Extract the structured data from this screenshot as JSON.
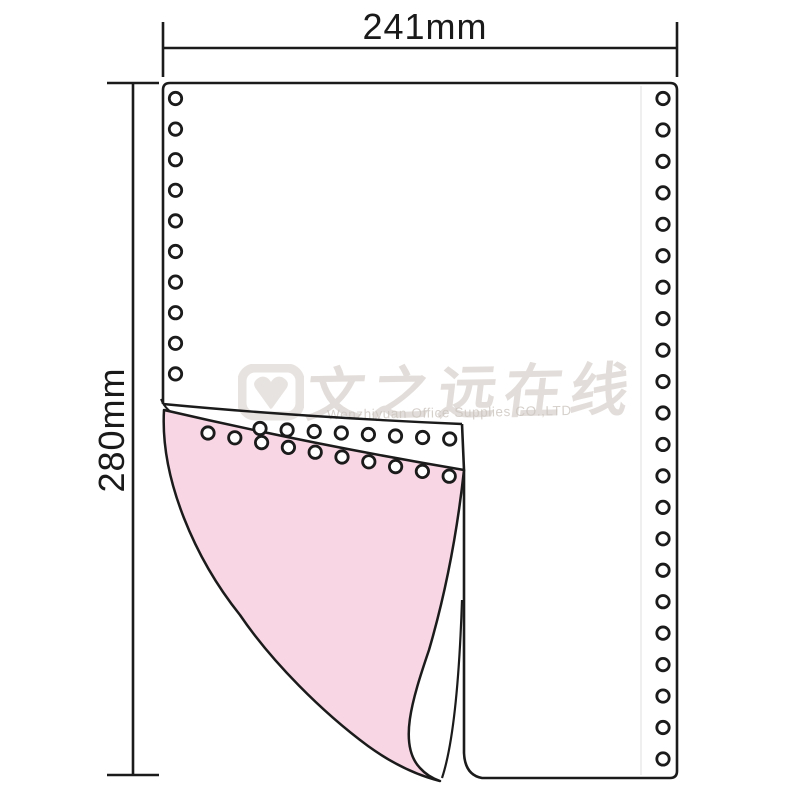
{
  "page": {
    "background": "#ffffff"
  },
  "dimensions": {
    "width_label": "241mm",
    "height_label": "280mm"
  },
  "watermark": {
    "cn_text": "文之远在线",
    "en_text": "Wenzhiyuan Office Supplies CO.,LTD",
    "color": "#cfc8c2"
  },
  "paper": {
    "line_color": "#1b1b1b",
    "sheet_fill": "#ffffff",
    "copy_sheet_color": "#f8d6e4",
    "perforation_line_color": "#ebebeb",
    "hole_style": {
      "radius": 6.2,
      "ring_width": 2.8,
      "fill": "#ffffff"
    },
    "holes": {
      "left_column": {
        "x": 175.5,
        "y_start": 98.5,
        "dy": 30.6,
        "count": 10
      },
      "right_column": {
        "x": 663,
        "y_start": 98.5,
        "dy": 31.45,
        "count": 22
      },
      "fold_white_row": {
        "x_start": 260,
        "y_start": 428.5,
        "dx": 27.1,
        "dy": 1.5,
        "count": 8
      },
      "fold_pink_row": {
        "x_start": 208,
        "y_start": 433,
        "dx": 26.8,
        "dy": 4.8,
        "count": 10
      }
    }
  }
}
